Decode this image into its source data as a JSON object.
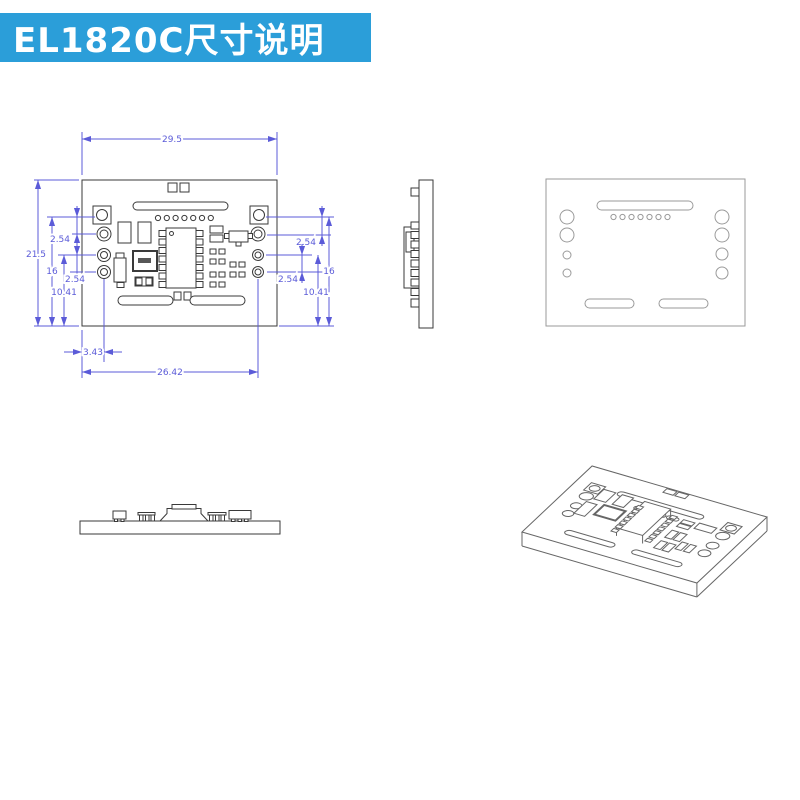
{
  "header": {
    "title": "EL1820C尺寸说明"
  },
  "colors": {
    "banner_bg": "#2B9ED9",
    "banner_text": "#FFFFFF",
    "dim": "#5B5BD8",
    "line_dark": "#3A3A3A",
    "line_light": "#9A9A9A",
    "line_iso": "#666666"
  },
  "views": {
    "front": "front-dimensioned-view",
    "side": "right-edge-view",
    "back": "back-view",
    "bottom": "bottom-edge-view",
    "iso": "isometric-view"
  },
  "dims": {
    "board_width": "29.5",
    "board_height": "21.5",
    "left_pin_row_height": "16",
    "left_pitch_top": "2.54",
    "left_hole_height": "10.41",
    "left_pitch_bottom": "2.54",
    "right_pitch_top": "2.54",
    "right_pin_row_height": "16",
    "right_pitch_bottom": "2.54",
    "right_hole_height": "10.41",
    "pad_edge_offset": "3.43",
    "pad_span": "26.42"
  }
}
